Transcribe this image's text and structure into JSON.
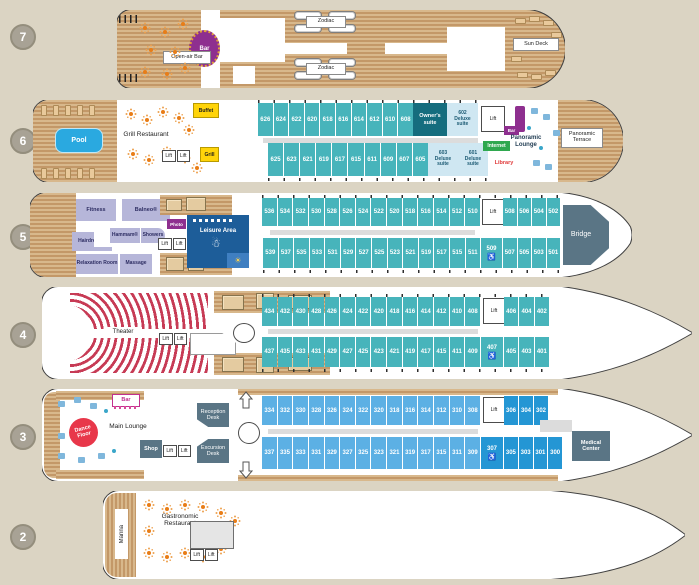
{
  "title": "Ship deck plan",
  "palette": {
    "background": "#dbd4c3",
    "hull_outline": "#3f3f3f",
    "wood": "#cdaa7d",
    "cabin_teal": "#47b4bb",
    "cabin_blue_light": "#5cb0e4",
    "cabin_blue_dark": "#2496d4",
    "owner_suite": "#156d7e",
    "deluxe_suite": "#cfe7f2",
    "accent_purple": "#8e2f8f",
    "accent_yellow": "#ffd40a",
    "accent_green": "#2fa84f",
    "accent_red": "#e8374a",
    "theater_red": "#c73b55",
    "leisure_blue": "#1d5d99",
    "spa_lavender": "#b6b6d9",
    "pool_blue": "#2aa9e0",
    "slate": "#5a7585"
  },
  "common": {
    "lift": "Lift"
  },
  "icons": {
    "wheelchair": "♿",
    "snowman": "☃",
    "sun": "☀"
  },
  "deck7": {
    "number": "7",
    "open_air_bar": "Open-air Bar",
    "bar": "Bar",
    "zodiac_top": "Zodiac",
    "zodiac_bottom": "Zodiac",
    "sun_deck": "Sun Deck"
  },
  "deck6": {
    "number": "6",
    "pool": "Pool",
    "buffet": "Buffet",
    "grill_restaurant": "Grill Restaurant",
    "grill": "Grill",
    "cabins_top": [
      "626",
      "624",
      "622",
      "620",
      "618",
      "616",
      "614",
      "612",
      "610",
      "608"
    ],
    "owners_suite": "Owner's suite",
    "suite_602": "602\nDeluxe\nsuite",
    "cabins_bottom": [
      "625",
      "623",
      "621",
      "619",
      "617",
      "615",
      "611",
      "609",
      "607",
      "605"
    ],
    "suite_603": "603\nDeluxe\nsuite",
    "suite_601": "601\nDeluxe\nsuite",
    "bar": "Bar",
    "panoramic_lounge": "Panoramic Lounge",
    "internet": "Internet",
    "library": "Library",
    "panoramic_terrace": "Panoramic Terrace"
  },
  "deck5": {
    "number": "5",
    "fitness": "Fitness",
    "balneo": "Balneo®",
    "hairdresser": "Hairdresser",
    "hammam": "Hammam®",
    "showers": "Showers",
    "relaxation_room": "Relaxation Room",
    "massage": "Massage",
    "photo": "Photo",
    "leisure_area": "Leisure Area",
    "cabins_top": [
      "536",
      "534",
      "532",
      "530",
      "528",
      "526",
      "524",
      "522",
      "520",
      "518",
      "516",
      "514",
      "512",
      "510"
    ],
    "cabins_top_fwd": [
      "508",
      "506",
      "504",
      "502"
    ],
    "cabins_bottom": [
      "539",
      "537",
      "535",
      "533",
      "531",
      "529",
      "527",
      "525",
      "523",
      "521",
      "519",
      "517",
      "515",
      "511"
    ],
    "cabin_hc": "509",
    "cabins_bottom_fwd": [
      "507",
      "505",
      "503",
      "501"
    ],
    "bridge": "Bridge"
  },
  "deck4": {
    "number": "4",
    "theater": "Theater",
    "cabins_top": [
      "434",
      "432",
      "430",
      "428",
      "426",
      "424",
      "422",
      "420",
      "418",
      "416",
      "414",
      "412",
      "410",
      "408"
    ],
    "cabins_top_fwd": [
      "406",
      "404",
      "402"
    ],
    "cabins_bottom": [
      "437",
      "435",
      "433",
      "431",
      "429",
      "427",
      "425",
      "423",
      "421",
      "419",
      "417",
      "415",
      "411",
      "409"
    ],
    "cabin_hc": "407",
    "cabins_bottom_fwd": [
      "405",
      "403",
      "401"
    ]
  },
  "deck3": {
    "number": "3",
    "bar": "Bar",
    "dance_floor": "Dance Floor",
    "main_lounge": "Main Lounge",
    "shop": "Shop",
    "reception_desk": "Reception Desk",
    "excursion_desk": "Excursion Desk",
    "cabins_top": [
      "334",
      "332",
      "330",
      "328",
      "326",
      "324",
      "322",
      "320",
      "318",
      "316",
      "314",
      "312",
      "310",
      "308"
    ],
    "cabins_top_fwd": [
      "306",
      "304",
      "302"
    ],
    "cabins_bottom": [
      "337",
      "335",
      "333",
      "331",
      "329",
      "327",
      "325",
      "323",
      "321",
      "319",
      "317",
      "315",
      "311",
      "309"
    ],
    "cabin_hc": "307",
    "cabins_bottom_fwd": [
      "305",
      "303",
      "301",
      "300"
    ],
    "medical_center": "Medical Center"
  },
  "deck2": {
    "number": "2",
    "marina": "Marina",
    "gastronomic_restaurant": "Gastronomic\nRestaurant"
  }
}
